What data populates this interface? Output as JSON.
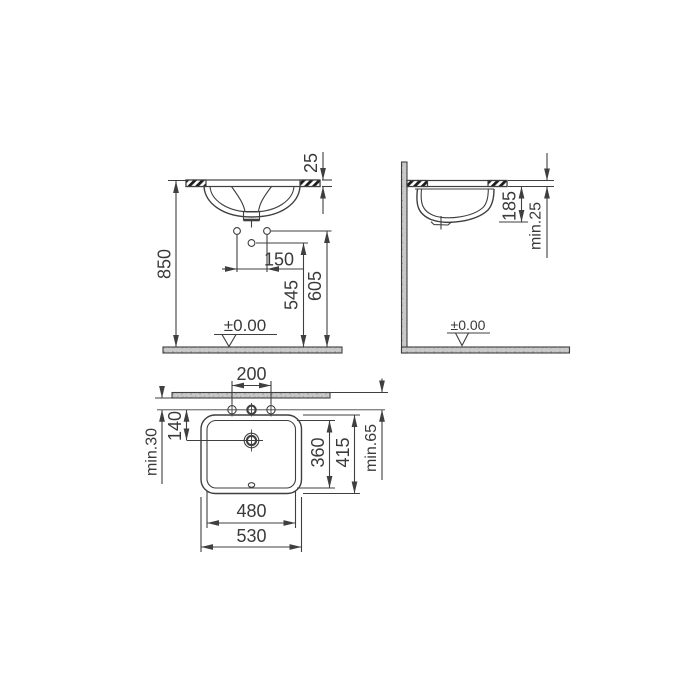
{
  "colors": {
    "line": "#3f3f3f",
    "text": "#3a3a3a",
    "hatch": "#1c1c1c",
    "surface": "#c9c9c9",
    "speckle": "#8f8f8f",
    "background": "#ffffff"
  },
  "front_view": {
    "dims": {
      "counter_thickness": "25",
      "rim_height_from_floor": "850",
      "fixing_hole_spacing": "150",
      "drain_hole_height": "545",
      "fixing_holes_height": "605"
    },
    "floor_level_label": "±0.00"
  },
  "side_view": {
    "dims": {
      "bowl_depth_below_counter": "185",
      "counter_thickness_min": "min.25"
    },
    "floor_level_label": "±0.00"
  },
  "plan_view": {
    "dims": {
      "tap_hole_spacing": "200",
      "counter_edge_to_holes_min": "min.30",
      "holes_to_drain": "140",
      "bowl_inner_depth": "360",
      "bowl_outer_depth": "415",
      "wall_to_holes_min": "min.65",
      "bowl_inner_width": "480",
      "bowl_outer_width": "530"
    }
  }
}
